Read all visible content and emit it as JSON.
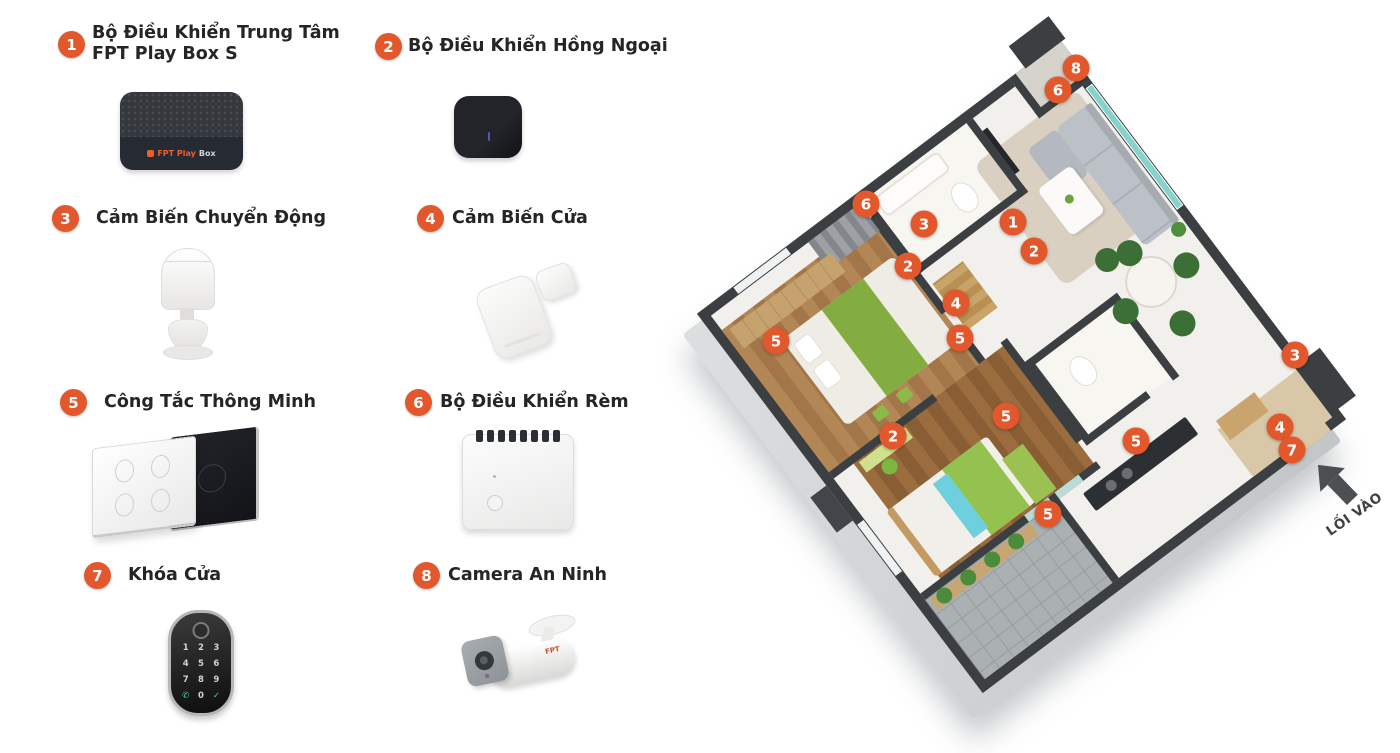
{
  "legend": {
    "items": [
      {
        "number": "1",
        "device": "fpt-play-box",
        "lines": [
          "Bộ Điều Khiển Trung Tâm",
          "FPT Play Box S"
        ],
        "device_text_primary": "FPT Play",
        "device_text_secondary": "Box"
      },
      {
        "number": "2",
        "device": "ir-controller",
        "lines": [
          "Bộ Điều Khiển Hồng Ngoại"
        ]
      },
      {
        "number": "3",
        "device": "motion-sensor",
        "lines": [
          "Cảm Biến Chuyển Động"
        ]
      },
      {
        "number": "4",
        "device": "door-sensor",
        "lines": [
          "Cảm Biến Cửa"
        ]
      },
      {
        "number": "5",
        "device": "smart-switch",
        "lines": [
          "Công Tắc Thông Minh"
        ]
      },
      {
        "number": "6",
        "device": "curtain-controller",
        "lines": [
          "Bộ Điều Khiển Rèm"
        ]
      },
      {
        "number": "7",
        "device": "door-lock",
        "lines": [
          "Khóa Cửa"
        ],
        "keypad": [
          "1",
          "2",
          "3",
          "4",
          "5",
          "6",
          "7",
          "8",
          "9",
          "✆",
          "0",
          "✓"
        ]
      },
      {
        "number": "8",
        "device": "security-camera",
        "lines": [
          "Camera An Ninh"
        ],
        "device_text": "FPT"
      }
    ]
  },
  "floor_plan": {
    "entrance_label": "LỐI VÀO",
    "markers": [
      {
        "number": "8",
        "x": 1076,
        "y": 68
      },
      {
        "number": "6",
        "x": 1058,
        "y": 90
      },
      {
        "number": "6",
        "x": 866,
        "y": 204
      },
      {
        "number": "3",
        "x": 924,
        "y": 224
      },
      {
        "number": "1",
        "x": 1013,
        "y": 222
      },
      {
        "number": "2",
        "x": 1034,
        "y": 251
      },
      {
        "number": "2",
        "x": 908,
        "y": 266
      },
      {
        "number": "4",
        "x": 956,
        "y": 303
      },
      {
        "number": "5",
        "x": 960,
        "y": 338
      },
      {
        "number": "5",
        "x": 776,
        "y": 341
      },
      {
        "number": "3",
        "x": 1295,
        "y": 355
      },
      {
        "number": "5",
        "x": 1006,
        "y": 416
      },
      {
        "number": "2",
        "x": 893,
        "y": 436
      },
      {
        "number": "5",
        "x": 1136,
        "y": 441
      },
      {
        "number": "4",
        "x": 1280,
        "y": 427
      },
      {
        "number": "7",
        "x": 1292,
        "y": 450
      },
      {
        "number": "5",
        "x": 1048,
        "y": 514
      }
    ]
  },
  "colors": {
    "badge": "#E2582C",
    "wall": "#3B3F42",
    "base": "#C8CCCD",
    "wood": "#A97C4C",
    "green": "#84AD41",
    "glass": "#87D3CB",
    "sofa": "#BCC1C7",
    "chair": "#3C6F35"
  }
}
